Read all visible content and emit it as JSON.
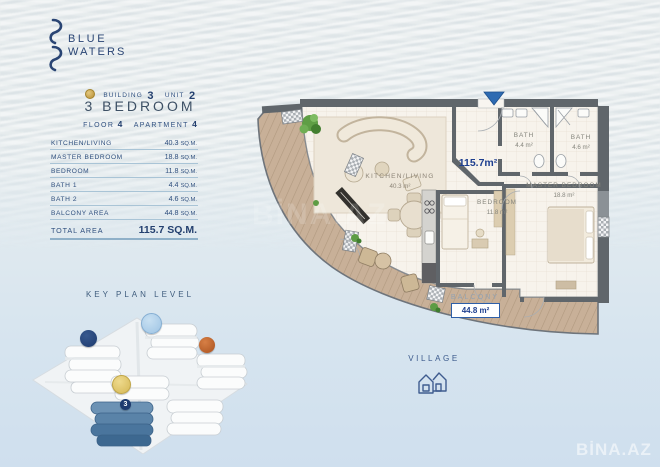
{
  "brand": {
    "name_line1": "BLUE",
    "name_line2": "WATERS"
  },
  "unit_info": {
    "building_label": "BUILDING",
    "building_value": "3",
    "unit_label": "UNIT",
    "unit_value": "2",
    "type_title": "3 BEDROOM",
    "floor_label": "FLOOR",
    "floor_value": "4",
    "apartment_label": "APARTMENT",
    "apartment_value": "4"
  },
  "area_table": {
    "rows": [
      {
        "label": "KITCHEN/LIVING",
        "value": "40.3",
        "unit": "SQ.M."
      },
      {
        "label": "MASTER BEDROOM",
        "value": "18.8",
        "unit": "SQ.M."
      },
      {
        "label": "BEDROOM",
        "value": "11.8",
        "unit": "SQ.M."
      },
      {
        "label": "BATH 1",
        "value": "4.4",
        "unit": "SQ.M."
      },
      {
        "label": "BATH 2",
        "value": "4.6",
        "unit": "SQ.M."
      },
      {
        "label": "BALCONY AREA",
        "value": "44.8",
        "unit": "SQ.M."
      }
    ],
    "total_label": "TOTAL AREA",
    "total_value": "115.7 SQ.M."
  },
  "key_plan": {
    "title": "KEY PLAN LEVEL",
    "highlight_badge": "3"
  },
  "floor_plan": {
    "total_area": "115.7m²",
    "kitchen_living": {
      "name": "KITCHEN/LIVING",
      "area": "40.3 m²"
    },
    "bath1": {
      "name": "BATH",
      "area": "4.4 m²"
    },
    "bath2": {
      "name": "BATH",
      "area": "4.6 m²"
    },
    "master_bedroom": {
      "name": "MASTER BEDROOM",
      "area": "18.8 m²"
    },
    "bedroom": {
      "name": "BEDROOM",
      "area": "11.8 m²"
    },
    "balcony": {
      "name": "BALCONY",
      "area": "44.8 m²"
    }
  },
  "village": {
    "label": "VILLAGE"
  },
  "watermark": {
    "text": "BİNA.AZ"
  },
  "colors": {
    "accent_navy": "#24406f",
    "plan_area_navy": "#1d3e8f",
    "arrow_blue": "#2e6bb2",
    "deck_tan": "#c8b098",
    "badge_navy": "#1f3d72",
    "badge_lightblue": "#a9cce9",
    "badge_orange": "#c4622e",
    "badge_yellow": "#e7cf6f"
  }
}
